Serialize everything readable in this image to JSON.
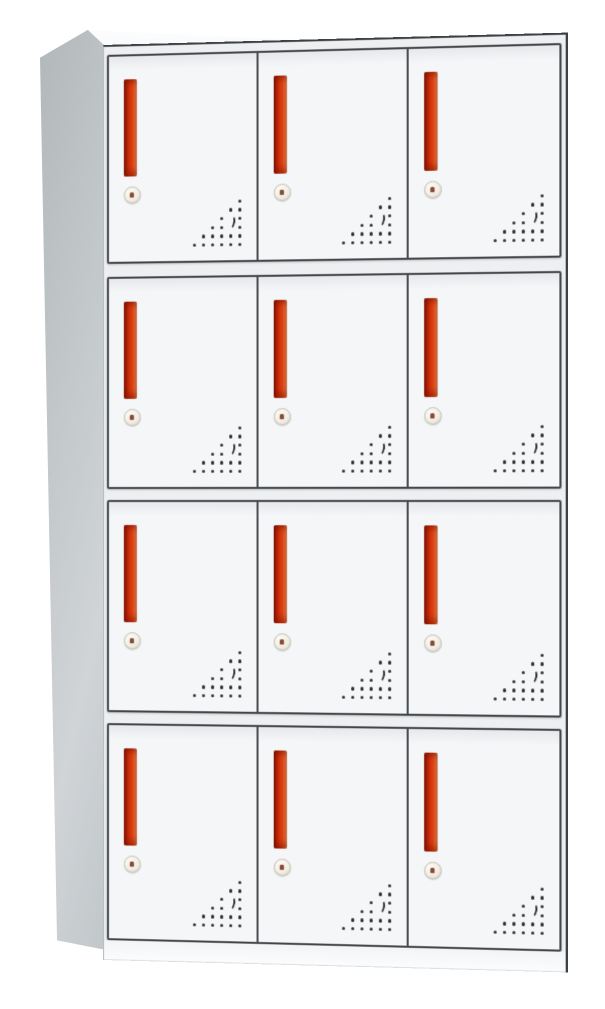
{
  "image": {
    "description": "Product photo of a 12-door steel locker cabinet with red vertical handles, round key locks and triangular ventilation hole patterns",
    "background_color": "#ffffff"
  },
  "cabinet": {
    "rows": 4,
    "columns": 3,
    "door_count": 12,
    "colors": {
      "background": "#ffffff",
      "door_face": "#f4f6f8",
      "door_face_top": "#e6e8eb",
      "door_outline": "#43464a",
      "frame_face": "#edeff1",
      "divider": "#4a4d51",
      "side_panel_light": "#d0d4d7",
      "side_panel": "#c1c6c9",
      "side_panel_dark": "#b2b7ba",
      "top_surface": "#f5f7f8",
      "edge_line": "#3e4144",
      "handle_dark": "#7e1804",
      "handle_mid": "#d23110",
      "handle_light": "#f4854d",
      "lock_body": "#f2eee5",
      "lock_ring": "#c6c0b2",
      "keyhole": "#8a4a33",
      "vent_dot": "#2e3134",
      "plinth": "#f3f4f6"
    },
    "door": {
      "handle": "vertical-red-bar-handle",
      "lock": "round-cam-key-lock",
      "vent": "triangular-perforation-pattern-with-crescent",
      "vent_pattern": [
        "-----o",
        "----oo",
        "---o-o",
        "--oo-o",
        "-ooooo",
        "oooooo"
      ],
      "vent_moon": {
        "col": 5,
        "row_start": 3
      }
    }
  }
}
